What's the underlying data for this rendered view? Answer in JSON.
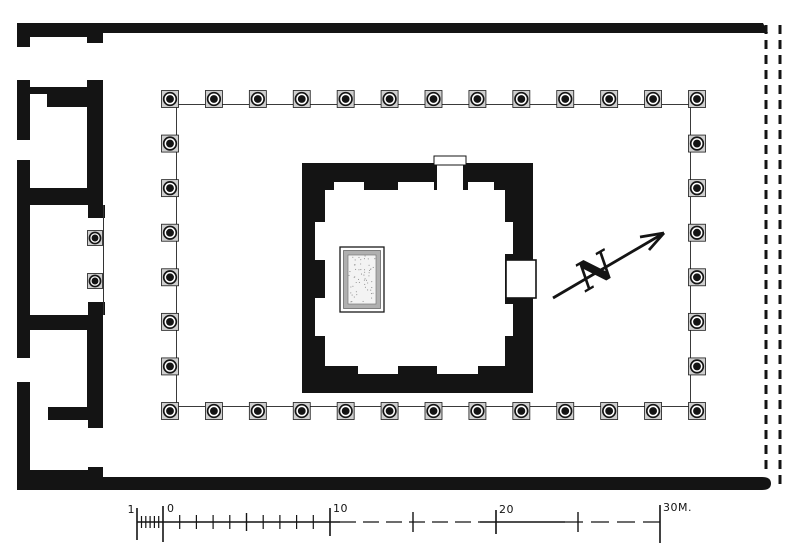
{
  "figure": {
    "kind": "temple-floor-plan",
    "description": "Black ink plan: square cella with buttressed walls and stippled altar base, set in a colonnaded court; row of rooms along the west side; restored east edge shown dashed; north arrow; metric scale bar"
  },
  "colors": {
    "ink": "#141414",
    "paper": "#ffffff",
    "column_plinth": "#cfcfcf",
    "altar_band": "#b0b0b0",
    "altar_inner": "#f3f3f3"
  },
  "colonnade": {
    "columns_top": 13,
    "columns_bottom": 13,
    "columns_left": 8,
    "columns_right": 8,
    "columns_in_antis": 2
  },
  "north_arrow": {
    "label": "N"
  },
  "scale_bar": {
    "unit": "M.",
    "label_minus1": "1",
    "label_0": "0",
    "label_10": "10",
    "label_20": "20",
    "label_30": "30M."
  }
}
